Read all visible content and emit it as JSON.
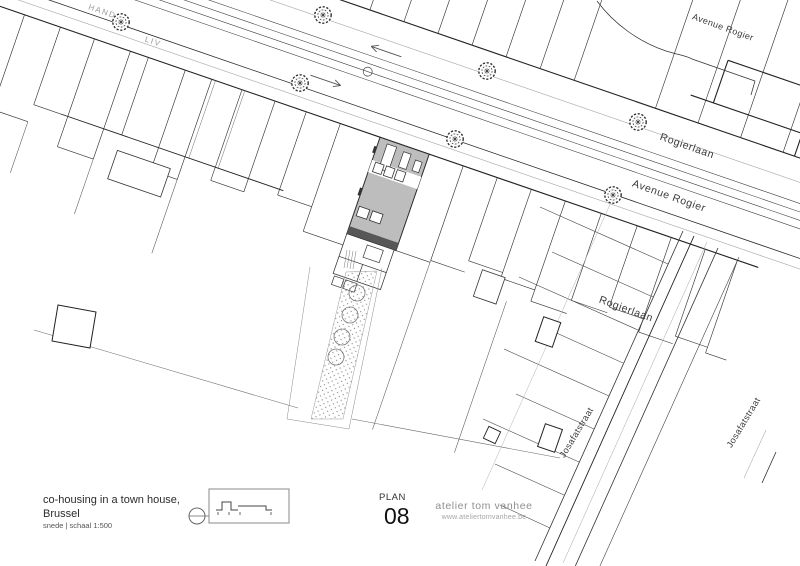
{
  "plan": {
    "street_labels": {
      "hand": "HAND",
      "liv": "LIV",
      "avenue_rogier_top": "Avenue Rogier",
      "rogierlaan_avenue": "Rogierlaan",
      "avenue_rogier_main": "Avenue Rogier",
      "rogierlaan_lower": "Rogierlaan",
      "josafatstraat_west": "Josafatstraat",
      "josafatstraat_east": "Josafatstraat"
    }
  },
  "title_block": {
    "project_title_line1": "co-housing in a town house,",
    "project_title_line2": "Brussel",
    "scale_note": "snede | schaal 1:500",
    "sheet_label": "PLAN",
    "sheet_number": "08",
    "studio_name": "atelier tom vanhee",
    "studio_url": "www.ateliertomvanhee.be"
  },
  "colors": {
    "line": "#222222",
    "line_gray": "#a3a3a3",
    "building_fill": "#bdbdbd",
    "dark_band": "#575757",
    "muted_text": "#8f8f8f"
  }
}
